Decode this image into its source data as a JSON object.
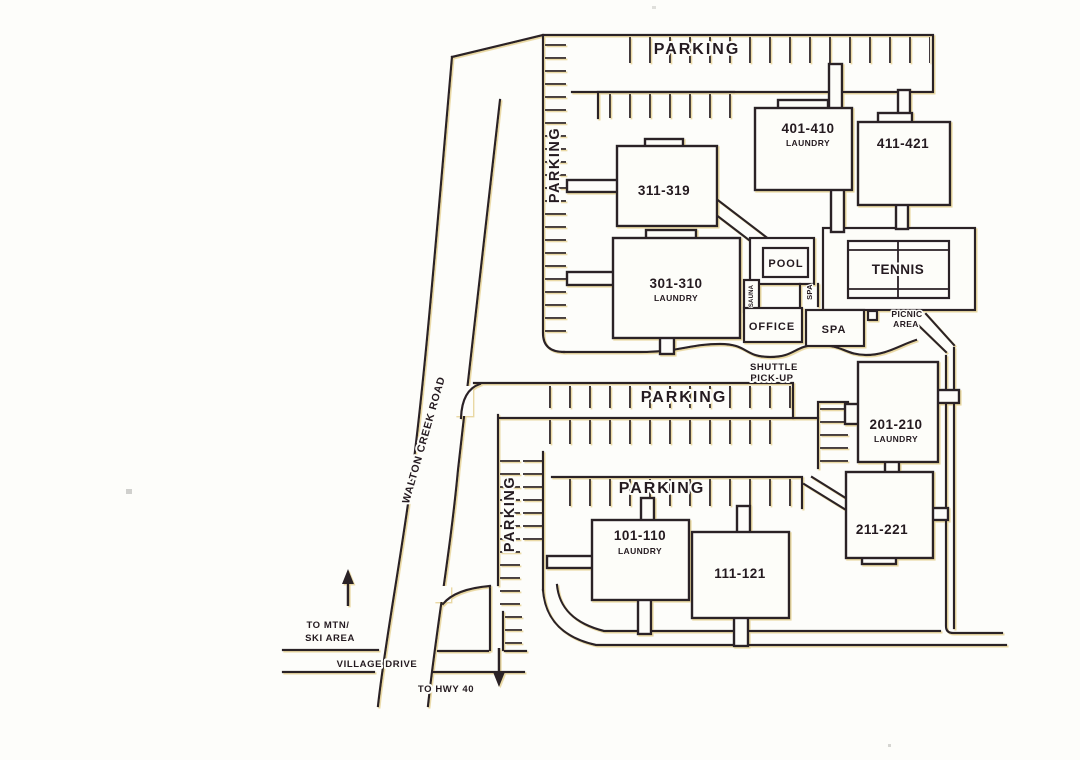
{
  "map": {
    "parking_labels": {
      "top": "PARKING",
      "left_upper": "PARKING",
      "middle": "PARKING",
      "lower": "PARKING",
      "left_lower": "PARKING"
    },
    "buildings": {
      "b311": {
        "units": "311-319"
      },
      "b401": {
        "units": "401-410",
        "laundry": "LAUNDRY"
      },
      "b411": {
        "units": "411-421"
      },
      "b301": {
        "units": "301-310",
        "laundry": "LAUNDRY"
      },
      "b201": {
        "units": "201-210",
        "laundry": "LAUNDRY"
      },
      "b211": {
        "units": "211-221"
      },
      "b101": {
        "units": "101-110",
        "laundry": "LAUNDRY"
      },
      "b111": {
        "units": "111-121"
      }
    },
    "amenities": {
      "pool": "POOL",
      "tennis": "TENNIS",
      "spa_corridor": "SPA",
      "sauna": "SAUNA",
      "office": "OFFICE",
      "spa": "SPA",
      "picnic_line1": "PICNIC",
      "picnic_line2": "AREA",
      "shuttle_line1": "SHUTTLE",
      "shuttle_line2": "PICK-UP"
    },
    "roads": {
      "walton_creek": "WALTON CREEK ROAD",
      "village_drive": "VILLAGE DRIVE",
      "to_mtn_line1": "TO MTN/",
      "to_mtn_line2": "SKI AREA",
      "to_hwy": "TO HWY 40"
    },
    "colors": {
      "ink": "#2a2026",
      "halo": "#e4cf8e",
      "paper": "#fdfdfa"
    }
  }
}
